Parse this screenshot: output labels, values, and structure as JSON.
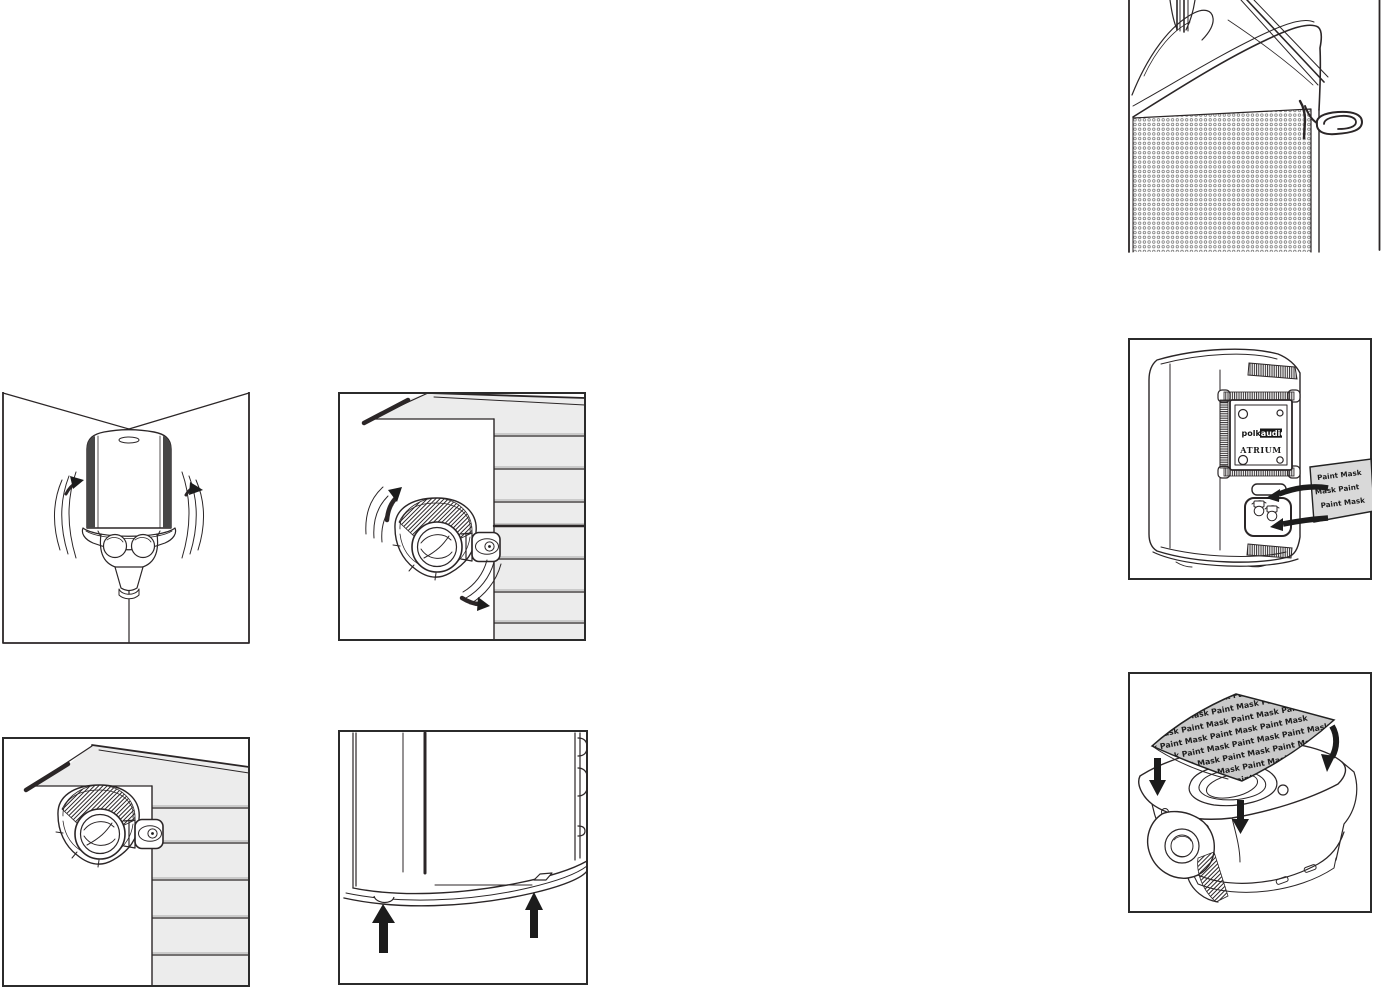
{
  "colors": {
    "ink": "#2b2627",
    "frame": "#2b2b2b",
    "siding_fill": "#ececec",
    "mask_sheet_fill": "#c9c9c9",
    "sticker_fill": "#d9d9d9",
    "arrow_fill": "#1c1c1c"
  },
  "icons": [
    "paperclip-icon",
    "rotate-up-arrow-icon",
    "rotate-down-arrow-icon",
    "swing-arrow-icon",
    "up-arrow-icon",
    "down-arrow-icon"
  ],
  "figures": {
    "back_panel": {
      "logo_polk": "polk",
      "logo_audio": "audio",
      "model_label": "ATRIUM",
      "sticker_lines": [
        "Paint Mask",
        "Mask   Paint",
        "Paint Mask"
      ]
    },
    "paint_mask_sheet": {
      "rows": [
        "Paint Mask   Paint Mask   Paint Mask   Paint Mask",
        "Paint Mask   Paint Mask   Paint Mask   Paint Mask",
        "Paint Mask   Paint Mask   Paint Mask   Paint Mask",
        "Paint Mask   Paint Mask   Paint Mask   Paint Mask",
        "Paint Mask   Paint Mask   Paint Mask   Paint Mask",
        "Paint Mask   Paint Mask   Paint Mask   Paint Mask",
        "Paint Mask   Paint Mask   Paint Mask   Paint Mask",
        "Paint Mask   Paint Mask   Paint Mask   Paint Mask"
      ]
    }
  }
}
